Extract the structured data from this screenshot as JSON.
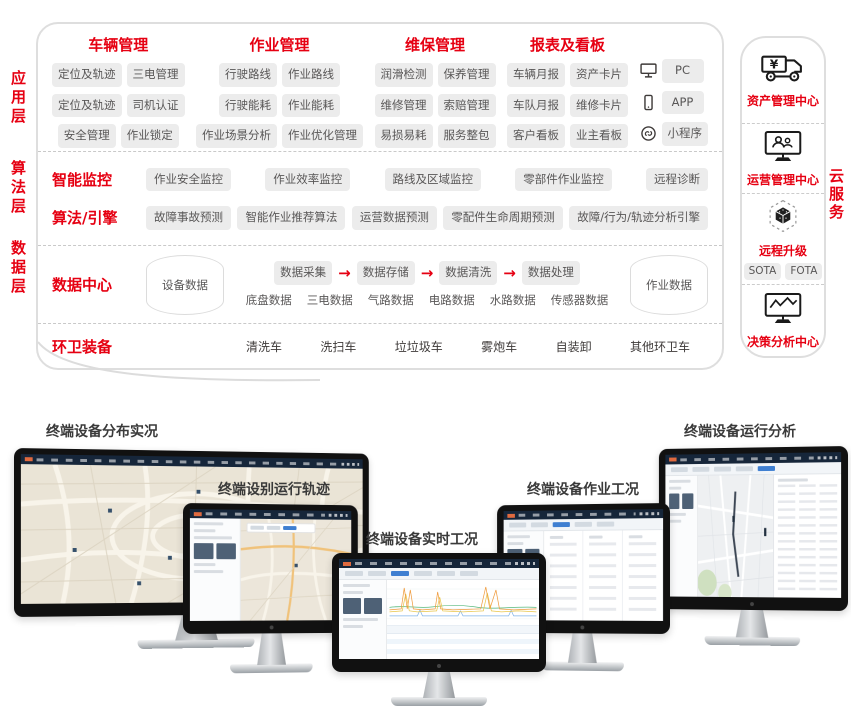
{
  "colors": {
    "accent_red": "#e60012",
    "pill_bg": "#ececec",
    "pill_text": "#595757",
    "box_border": "#dedede",
    "navbar_dark": "#16263a",
    "active_tab_blue": "#3f7fd1"
  },
  "layer_labels": [
    {
      "label": "应用层"
    },
    {
      "label": "算法层"
    },
    {
      "label": "数据层"
    }
  ],
  "app_groups": [
    {
      "title": "车辆管理",
      "rows": [
        [
          "定位及轨迹",
          "三电管理"
        ],
        [
          "定位及轨迹",
          "司机认证"
        ],
        [
          "安全管理",
          "作业锁定"
        ]
      ]
    },
    {
      "title": "作业管理",
      "rows": [
        [
          "行驶路线",
          "作业路线"
        ],
        [
          "行驶能耗",
          "作业能耗"
        ],
        [
          "作业场景分析",
          "作业优化管理"
        ]
      ]
    },
    {
      "title": "维保管理",
      "rows": [
        [
          "润滑检测",
          "保养管理"
        ],
        [
          "维修管理",
          "索赔管理"
        ],
        [
          "易损易耗",
          "服务整包"
        ]
      ]
    },
    {
      "title": "报表及看板",
      "rows": [
        [
          "车辆月报",
          "资产卡片"
        ],
        [
          "车队月报",
          "维修卡片"
        ],
        [
          "客户看板",
          "业主看板"
        ]
      ]
    }
  ],
  "access_devices": [
    {
      "icon": "pc-icon",
      "label": "PC"
    },
    {
      "icon": "mobile-app-icon",
      "label": "APP"
    },
    {
      "icon": "miniprogram-icon",
      "label": "小程序"
    }
  ],
  "algo_rows": [
    {
      "label": "智能监控",
      "pills": [
        "作业安全监控",
        "作业效率监控",
        "路线及区域监控",
        "零部件作业监控",
        "远程诊断"
      ]
    },
    {
      "label": "算法/引擎",
      "pills": [
        "故障事故预测",
        "智能作业推荐算法",
        "运营数据预测",
        "零配件生命周期预测",
        "故障/行为/轨迹分析引擎"
      ]
    }
  ],
  "data_center": {
    "label": "数据中心",
    "left_store": "设备数据",
    "flow": [
      "数据采集",
      "数据存储",
      "数据清洗",
      "数据处理"
    ],
    "arrow": "→",
    "sub_data": [
      "底盘数据",
      "三电数据",
      "气路数据",
      "电路数据",
      "水路数据",
      "传感器数据"
    ],
    "right_store": "作业数据"
  },
  "equipment": {
    "label": "环卫装备",
    "items": [
      "清洗车",
      "洗扫车",
      "垃垃圾车",
      "雾炮车",
      "自装卸",
      "其他环卫车"
    ]
  },
  "cloud_panel": {
    "side_label": "云服务",
    "sections": [
      {
        "icon": "asset-truck-icon",
        "label": "资产管理中心"
      },
      {
        "icon": "operations-monitor-icon",
        "label": "运营管理中心"
      },
      {
        "icon": "remote-upgrade-cube-icon",
        "label": "远程升级",
        "pills": [
          "SOTA",
          "FOTA"
        ]
      },
      {
        "icon": "analysis-monitor-icon",
        "label": "决策分析中心"
      }
    ]
  },
  "monitors": [
    {
      "label": "终端设备分布实况"
    },
    {
      "label": "终端设别运行轨迹"
    },
    {
      "label": "终端设备实时工况"
    },
    {
      "label": "终端设备作业工况"
    },
    {
      "label": "终端设备运行分析"
    }
  ]
}
